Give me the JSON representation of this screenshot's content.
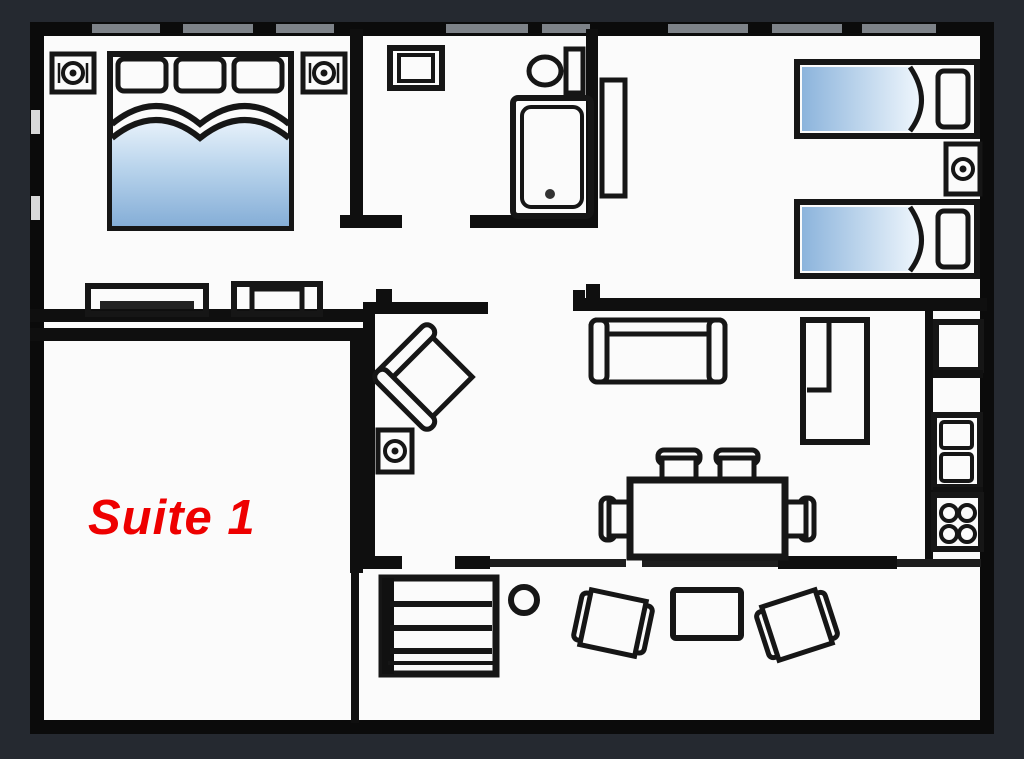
{
  "scene": {
    "type": "floor-plan",
    "name": "Suite 1 apartment floor plan"
  },
  "label": {
    "text": "Suite 1",
    "color": "#ee0000"
  },
  "colors": {
    "background": "#252930",
    "floor": "#fbfbfb",
    "wall": "#0c0c0c",
    "line": "#161616",
    "window_gray": "#7d8288",
    "bed_blue_top": "#e9f2fb",
    "bed_blue_bottom": "#85aed7"
  },
  "rooms": [
    {
      "name": "master-bedroom",
      "furniture": [
        "double-bed",
        "pillows-x3",
        "nightstand-speaker-left",
        "nightstand-speaker-right",
        "dresser",
        "side-table"
      ]
    },
    {
      "name": "bathroom",
      "furniture": [
        "wash-basin",
        "toilet",
        "bathtub"
      ]
    },
    {
      "name": "twin-bedroom",
      "furniture": [
        "twin-bed-top",
        "twin-bed-bottom",
        "nightstand-speaker",
        "open-door"
      ]
    },
    {
      "name": "living-dining",
      "furniture": [
        "armchair-diagonal",
        "speaker-unit",
        "sofa",
        "wardrobe-l-shape",
        "dining-table",
        "dining-chairs-x4"
      ]
    },
    {
      "name": "kitchen-strip",
      "furniture": [
        "fridge",
        "double-sink",
        "stove-4-burners"
      ]
    },
    {
      "name": "suite-room",
      "furniture": []
    },
    {
      "name": "terrace",
      "furniture": [
        "stairs",
        "post",
        "patio-chair-left",
        "patio-table",
        "patio-chair-right"
      ]
    }
  ]
}
